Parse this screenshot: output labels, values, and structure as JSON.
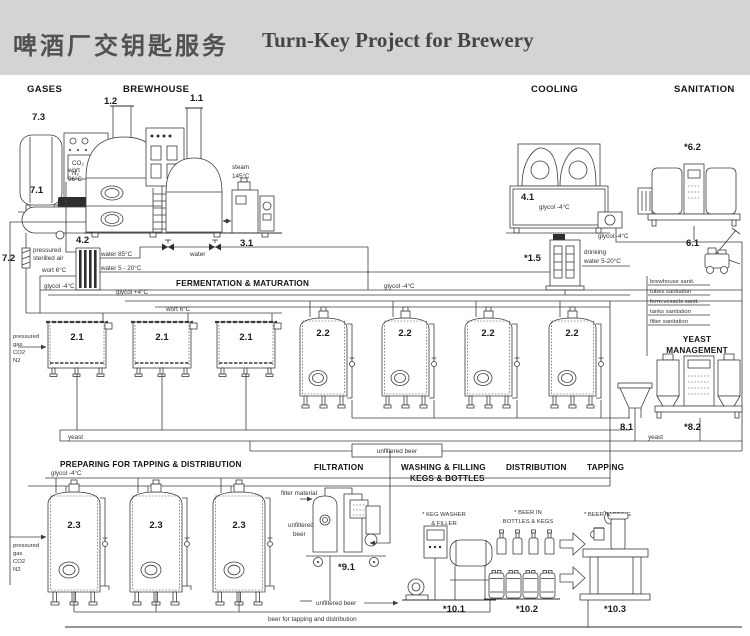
{
  "header": {
    "title_zh": "啤酒厂交钥匙服务",
    "title_en": "Turn-Key Project for Brewery"
  },
  "sections": {
    "gases": "GASES",
    "brewhouse": "BREWHOUSE",
    "cooling": "COOLING",
    "sanitation": "SANITATION",
    "fermentation": "FERMENTATION & MATURATION",
    "yeast1": "YEAST",
    "yeast2": "MANAGEMENT",
    "preparing": "PREPARING FOR TAPPING & DISTRIBUTION",
    "filtration": "FILTRATION",
    "washing1": "WASHING & FILLING",
    "washing2": "KEGS & BOTTLES",
    "distribution": "DISTRIBUTION",
    "tapping": "TAPPING"
  },
  "equipment": {
    "e73": "7.3",
    "e71": "7.1",
    "e72": "7.2",
    "e12": "1.2",
    "e11": "1.1",
    "e31": "3.1",
    "e42": "4.2",
    "e41": "4.1",
    "e15": "*1.5",
    "e62": "*6.2",
    "e61": "6.1",
    "e21": "2.1",
    "e22": "2.2",
    "e81": "8.1",
    "e82": "*8.2",
    "e23": "2.3",
    "e91": "*9.1",
    "e101": "*10.1",
    "e102": "*10.2",
    "e103": "*10.3"
  },
  "labels": {
    "wort_hot": [
      "wort",
      "96°C"
    ],
    "steam": [
      "steam",
      "145°C"
    ],
    "air": [
      "pressured",
      "sterilled air"
    ],
    "wort_cold": "wort 6°C",
    "water_hot": "water 85°C",
    "water_cold": "water 5 - 20°C",
    "water": "water",
    "glycol_minus": "glycol -4°C",
    "glycol_plus": "glycol +4°C",
    "gas": [
      "pressured",
      "gas",
      "CO2",
      "N2"
    ],
    "tank_gas": [
      "CO₂",
      "N₂"
    ],
    "drinking": [
      "drinking",
      "water 5-20°C"
    ],
    "yeast": "yeast",
    "unfiltered_beer": "unfiltered beer",
    "unfiltered_beer2": [
      "unfiltered",
      "beer"
    ],
    "filter_material": "filter material",
    "beer_for_tapping": "beer for tapping and distribution",
    "keg_washer": [
      "* KEG WASHER",
      "& FILLER"
    ],
    "beer_in": [
      "* BEER IN",
      "BOTTLES & KEGS"
    ],
    "beer_tapping": "* BEER TAPPING"
  },
  "sanitation_list": [
    "brewhouse sanit.",
    "tubes sanitation",
    "ferm.vessels sanit.",
    "tanks sanitation",
    "filter sanitation"
  ]
}
